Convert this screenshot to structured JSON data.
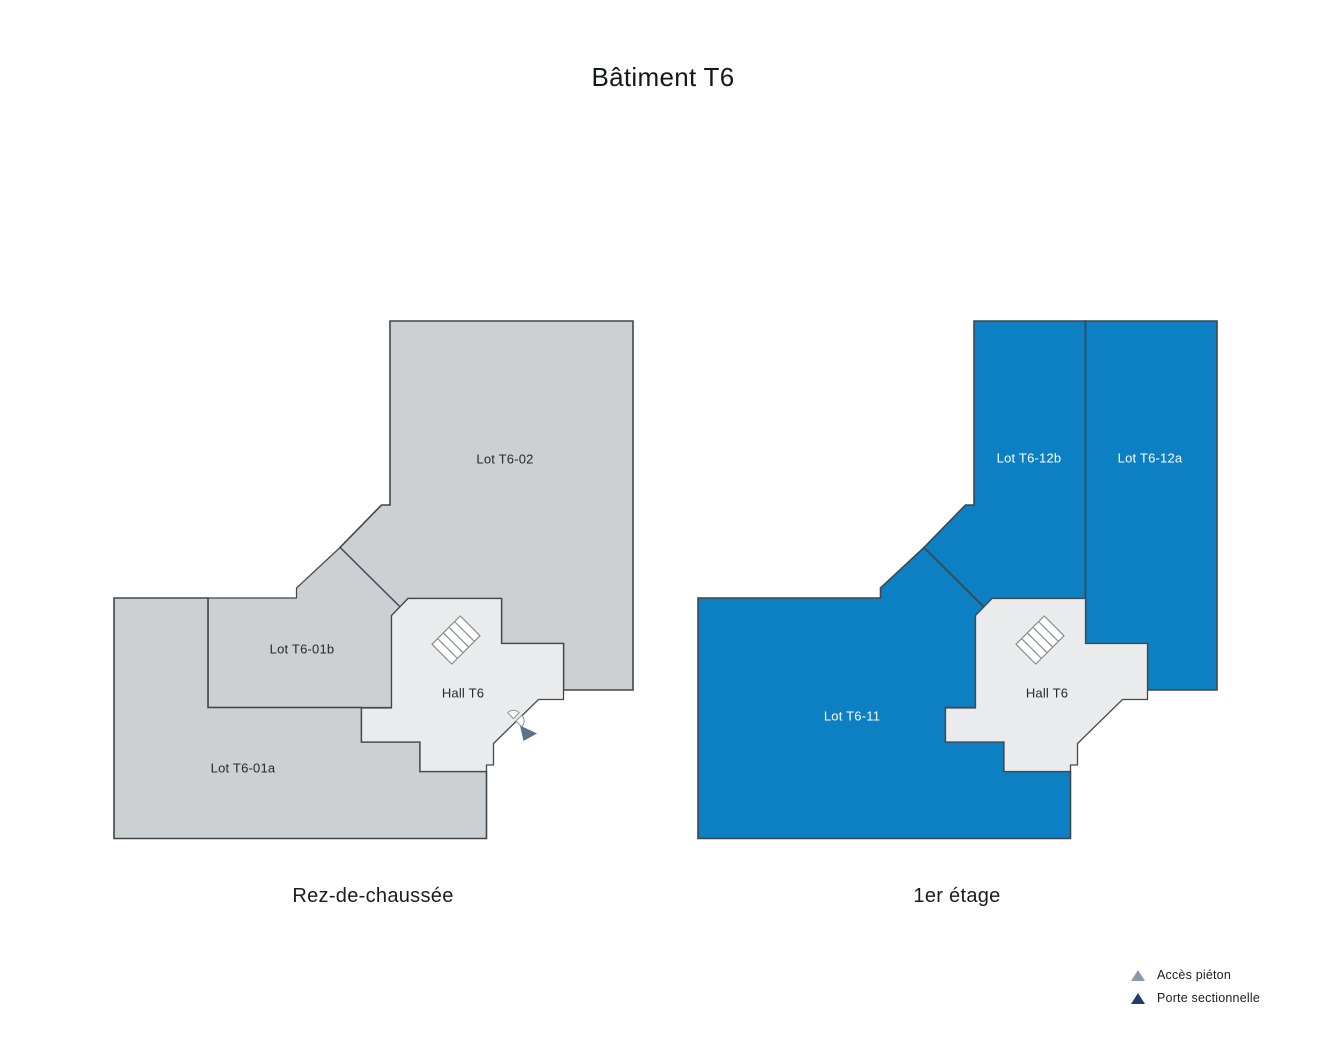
{
  "title": "Bâtiment T6",
  "floors": [
    {
      "caption": "Rez-de-chaussée",
      "hall_label": "Hall T6",
      "lots": [
        {
          "label": "Lot T6-02"
        },
        {
          "label": "Lot T6-01b"
        },
        {
          "label": "Lot T6-01a"
        }
      ]
    },
    {
      "caption": "1er étage",
      "hall_label": "Hall T6",
      "lots": [
        {
          "label": "Lot T6-12b"
        },
        {
          "label": "Lot T6-12a"
        },
        {
          "label": "Lot T6-11"
        }
      ]
    }
  ],
  "legend": {
    "items": [
      {
        "label": "Accès piéton",
        "color": "#8b99a9"
      },
      {
        "label": "Porte sectionnelle",
        "color": "#1f3f66"
      }
    ]
  },
  "colors": {
    "lot_gray": "#cdd0d2",
    "hall_gray": "#e9ebec",
    "lot_blue": "#0c80c3",
    "outline": "#3f464c",
    "access_marker": "#5b7389"
  }
}
